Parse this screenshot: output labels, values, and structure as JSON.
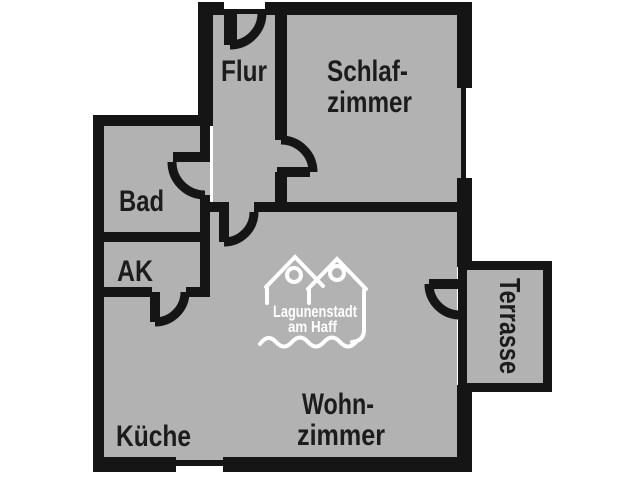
{
  "floorplan": {
    "labels": {
      "flur": "Flur",
      "schlafzimmer_line1": "Schlaf-",
      "schlafzimmer_line2": "zimmer",
      "bad": "Bad",
      "ak": "AK",
      "kueche": "Küche",
      "wohnzimmer_line1": "Wohn-",
      "wohnzimmer_line2": "zimmer",
      "terrasse": "Terrasse"
    },
    "logo": {
      "line1": "Lagunenstadt",
      "line2": "am Haff"
    },
    "colors": {
      "background": "#ffffff",
      "floor": "#b2b2b2",
      "wall": "#151515",
      "label_text": "#1c1c1c",
      "logo": "#ffffff"
    }
  }
}
